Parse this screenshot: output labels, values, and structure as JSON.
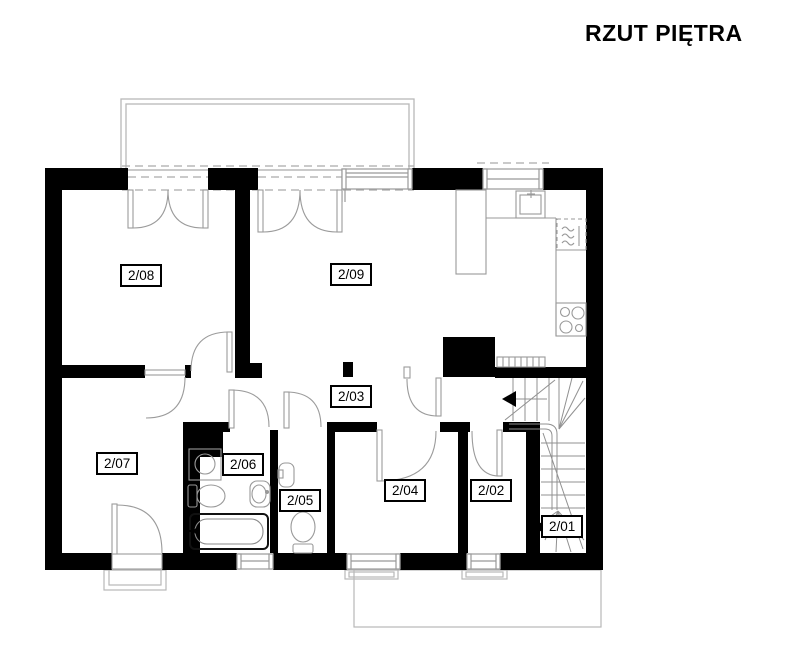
{
  "title": "RZUT PIĘTRA",
  "rooms": [
    {
      "label": "2/01"
    },
    {
      "label": "2/02"
    },
    {
      "label": "2/03"
    },
    {
      "label": "2/04"
    },
    {
      "label": "2/05"
    },
    {
      "label": "2/06"
    },
    {
      "label": "2/07"
    },
    {
      "label": "2/08"
    },
    {
      "label": "2/09"
    }
  ],
  "fixtures": [
    "kitchen-sink",
    "fridge",
    "stove-4-burners",
    "kitchen-counter",
    "washing-machine",
    "toilet",
    "washbasin",
    "bathtub",
    "wc-washbasin",
    "wc-toilet",
    "staircase",
    "direction-arrow"
  ],
  "outdoor": [
    "balcony-top",
    "terrace-bottom",
    "entry-steps"
  ],
  "colors": {
    "wall": "#000000",
    "fixture_line": "#999999",
    "outline_line": "#b8b8b8",
    "dash_line": "#aaaaaa",
    "text": "#000000"
  }
}
